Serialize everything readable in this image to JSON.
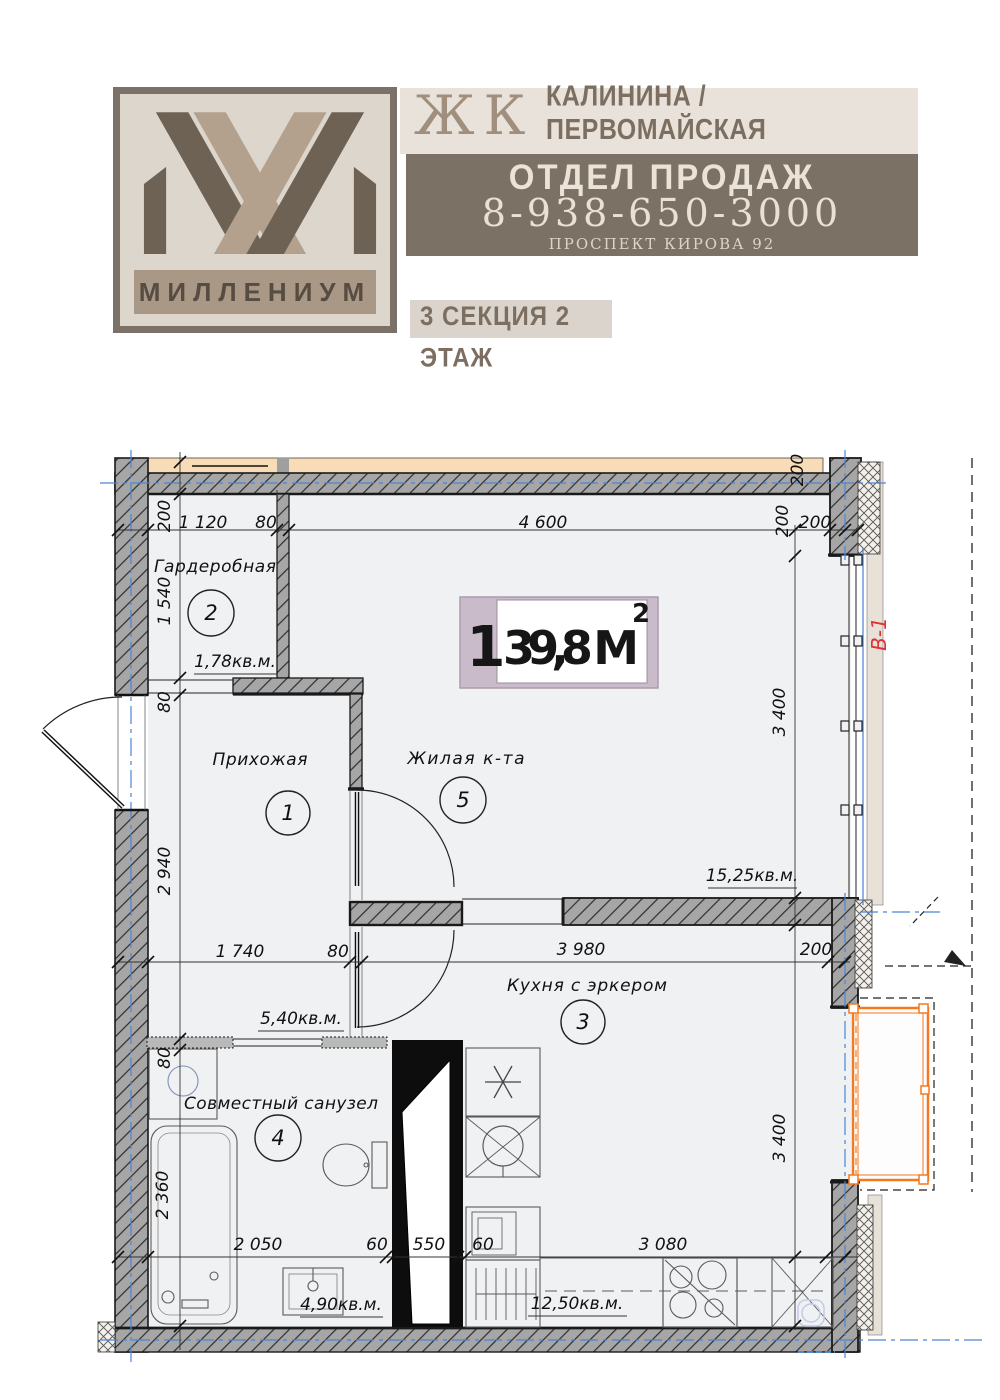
{
  "header": {
    "brand": "МИЛЛЕНИУМ",
    "complex_prefix": "ЖК",
    "complex_name": "КАЛИНИНА /ПЕРВОМАЙСКАЯ",
    "sales_label": "ОТДЕЛ ПРОДАЖ",
    "phone": "8-938-650-3000",
    "address": "ПРОСПЕКТ КИРОВА 92",
    "section_floor": "3 СЕКЦИЯ 2 ЭТАЖ"
  },
  "plan": {
    "badge": {
      "rooms_count": "1",
      "area": "39,8 М",
      "sup": "2"
    },
    "window_label": "В-1",
    "rooms": [
      {
        "number": "2",
        "name": "Гардеробная",
        "area": "1,78кв.м."
      },
      {
        "number": "1",
        "name": "Прихожая",
        "area": "5,40кв.м."
      },
      {
        "number": "5",
        "name": "Жилая к-та",
        "area": "15,25кв.м."
      },
      {
        "number": "3",
        "name": "Кухня с эркером",
        "area": "12,50кв.м."
      },
      {
        "number": "4",
        "name": "Совместный санузел",
        "area": "4,90кв.м."
      }
    ],
    "dims": {
      "top": [
        "200",
        "1 120",
        "80",
        "4 600",
        "200",
        "200",
        "200"
      ],
      "left": [
        "1 540",
        "80",
        "2 940",
        "80",
        "2 360"
      ],
      "mid": [
        "1 740",
        "80",
        "3 980",
        "200"
      ],
      "right": [
        "3 400",
        "3 400"
      ],
      "bottom": [
        "2 050",
        "60",
        "550",
        "60",
        "3 080"
      ]
    }
  },
  "colors": {
    "brand_brown": "#7c7165",
    "beige_band": "#e8e2da",
    "logo_dark": "#6e6255",
    "logo_light": "#b3a18d",
    "logo_bg": "#ddd6cd",
    "peach": "#f8dcb7",
    "bay_orange": "#f5791e",
    "axis_blue": "#4a86d8",
    "window_label_red": "#e03234",
    "badge_frame": "#cabbca",
    "wall_gray": "#a6a6a6"
  }
}
